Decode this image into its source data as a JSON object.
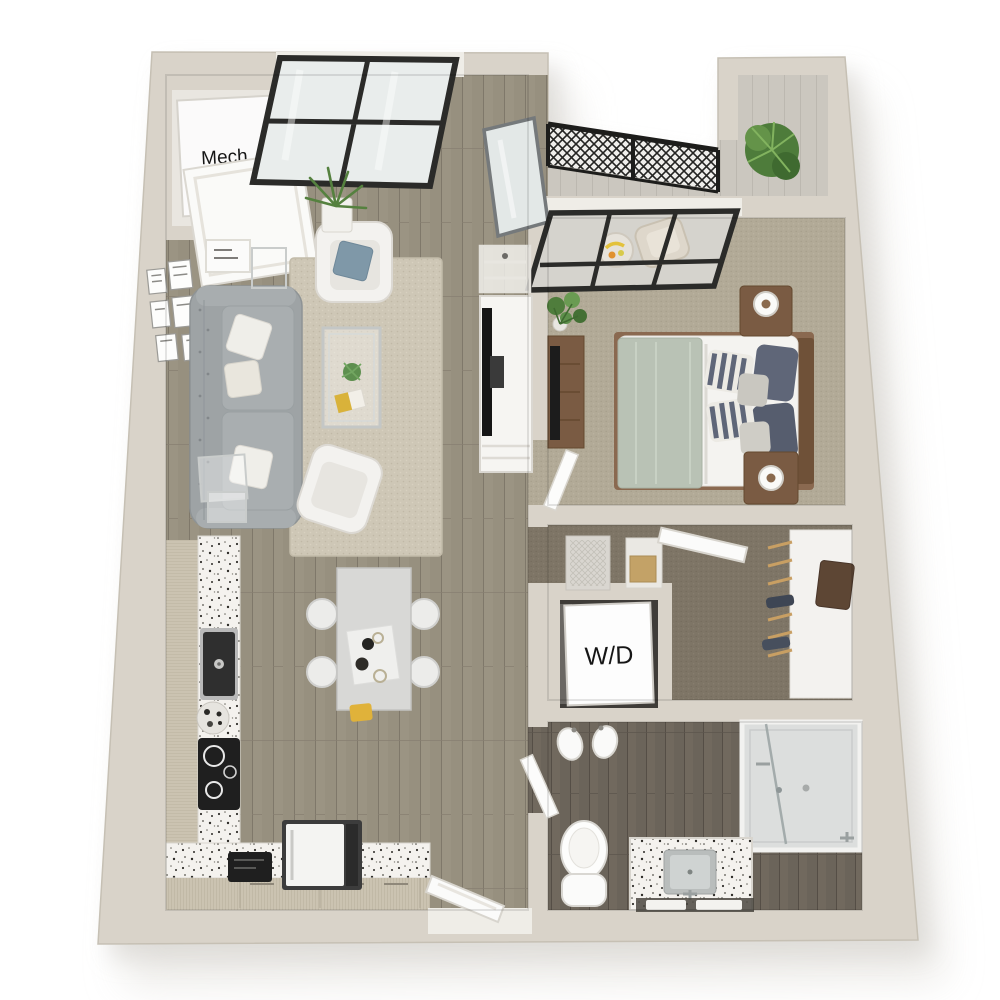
{
  "image_type": "3d-apartment-floor-plan-top-view",
  "labels": {
    "mech_closet": "Mech.",
    "washer_dryer": "W/D"
  },
  "colors": {
    "background": "#ffffff",
    "wall": "#d9d3c9",
    "wall_edge": "#c6c0b4",
    "wall_inner_face": "#e9e6e0",
    "sill_white": "#efede7",
    "window_frame": "#2b2b29",
    "glass": "#e9edec",
    "wood_floor": "#97907f",
    "wood_floor_dark": "#6b645a",
    "bedroom_carpet": "#b2aa97",
    "closet_carpet": "#7e7566",
    "balcony_floor": "#cbc7bf",
    "rug": "#cec7b6",
    "sofa_gray": "#9ea3a5",
    "counter_terrazzo": "#f4f2ee",
    "cabinet_wood": "#cbc3b1",
    "furniture_wood": "#7a5b43",
    "bed_duvet": "#b9c2b5",
    "pillow_navy": "#5f6678",
    "pillow_blue": "#7f98a8",
    "plant_green": "#55813f",
    "appliance_black": "#1f1f1f",
    "railing_black": "#1d1d1b",
    "label_text": "#161616",
    "shadow": "#d9d7d3"
  }
}
